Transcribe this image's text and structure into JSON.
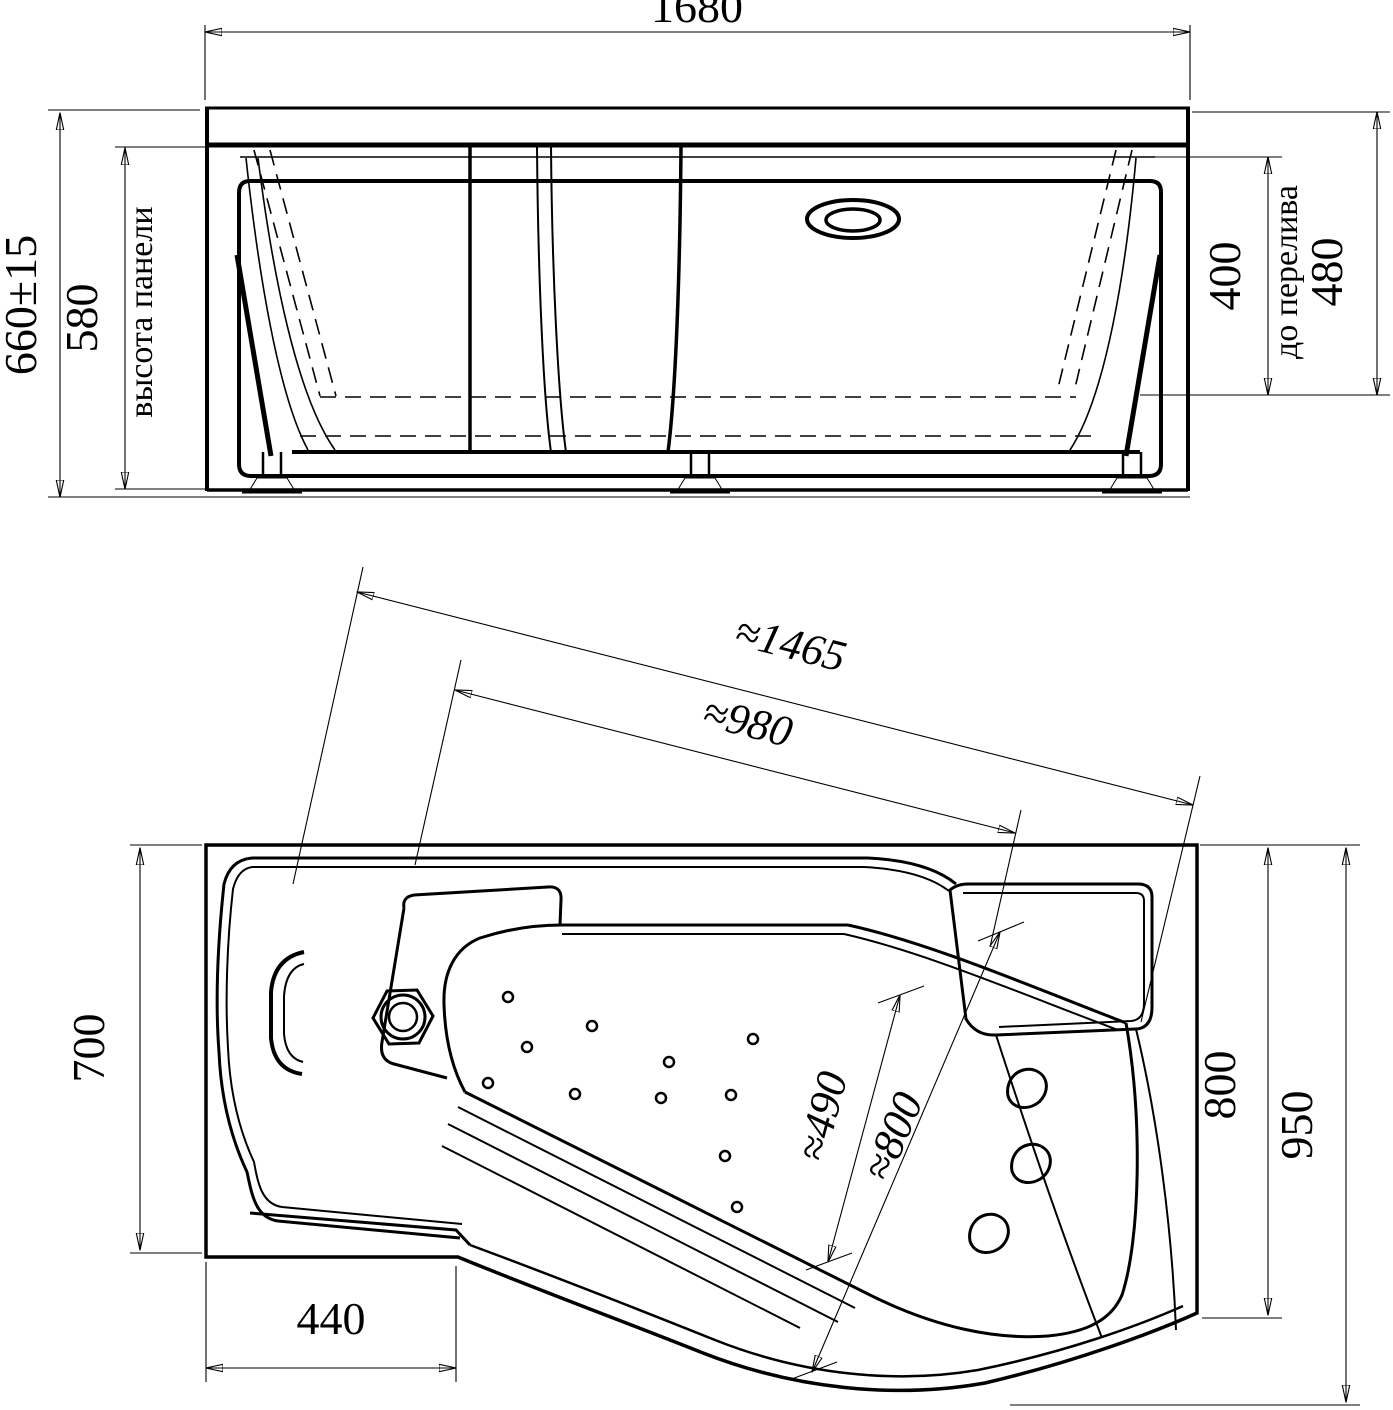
{
  "drawing": {
    "background": "#ffffff",
    "line_color": "#000000",
    "front_view": {
      "width": "1680",
      "total_height": "660±15",
      "panel_height": "580",
      "panel_height_note": "высота панели",
      "overflow_depth": "400",
      "overflow_note": "до перелива",
      "rim_height": "480"
    },
    "plan_view": {
      "diagonal_length": "≈1465",
      "diagonal_inner": "≈980",
      "left_width": "700",
      "bottom_offset": "440",
      "inner_width_small": "≈490",
      "inner_width_large": "≈800",
      "right_width_inner": "800",
      "right_width_outer": "950"
    }
  }
}
